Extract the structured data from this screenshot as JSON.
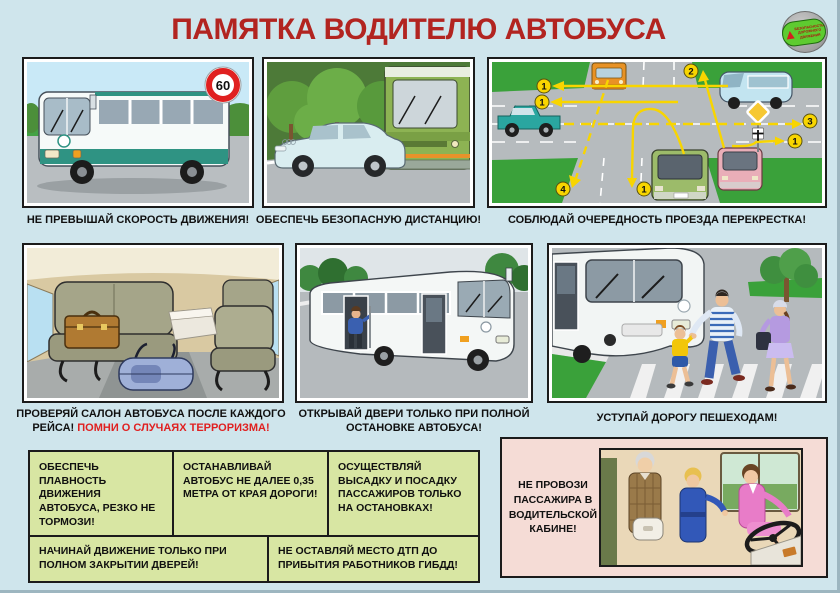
{
  "poster": {
    "title": "ПАМЯТКА ВОДИТЕЛЮ АВТОБУСА",
    "logo": {
      "line1": "БЕЗОПАСНОСТЬ",
      "line2": "ДОРОЖНОГО",
      "line3": "ДВИЖЕНИЯ"
    }
  },
  "panels": {
    "speed": {
      "caption": "НЕ ПРЕВЫШАЙ СКОРОСТЬ ДВИЖЕНИЯ!",
      "speed_sign": "60"
    },
    "distance": {
      "caption": "ОБЕСПЕЧЬ БЕЗОПАСНУЮ ДИСТАНЦИЮ!"
    },
    "intersection": {
      "caption": "СОБЛЮДАЙ ОЧЕРЕДНОСТЬ ПРОЕЗДА ПЕРЕКРЕСТКА!",
      "badges": [
        "1",
        "1",
        "2",
        "3",
        "1",
        "4",
        "1"
      ]
    },
    "salon": {
      "caption": "ПРОВЕРЯЙ САЛОН АВТОБУСА ПОСЛЕ КАЖДОГО РЕЙСА!",
      "caption_warning": "ПОМНИ О СЛУЧАЯХ ТЕРРОРИЗМА!"
    },
    "doors": {
      "caption": "ОТКРЫВАЙ ДВЕРИ ТОЛЬКО ПРИ ПОЛНОЙ ОСТАНОВКЕ АВТОБУСА!"
    },
    "pedestrians": {
      "caption": "УСТУПАЙ ДОРОГУ ПЕШЕХОДАМ!"
    }
  },
  "rules": [
    "ОБЕСПЕЧЬ ПЛАВНОСТЬ ДВИЖЕНИЯ АВТОБУСА, РЕЗКО НЕ ТОРМОЗИ!",
    "ОСТАНАВЛИВАЙ АВТОБУС НЕ ДАЛЕЕ 0,35 МЕТРА ОТ КРАЯ ДОРОГИ!",
    "ОСУЩЕСТВЛЯЙ ВЫСАДКУ И ПОСАДКУ ПАССАЖИРОВ ТОЛЬКО НА ОСТАНОВКАХ!",
    "НАЧИНАЙ ДВИЖЕНИЕ ТОЛЬКО ПРИ ПОЛНОМ ЗАКРЫТИИ ДВЕРЕЙ!",
    "НЕ ОСТАВЛЯЙ МЕСТО ДТП ДО ПРИБЫТИЯ РАБОТНИКОВ ГИБДД!"
  ],
  "cab_rule": {
    "text": "НЕ ПРОВОЗИ ПАССАЖИРА В ВОДИТЕЛЬСКОЙ КАБИНЕ!"
  },
  "colors": {
    "background": "#cfe5ec",
    "title": "#b22420",
    "warning_text": "#e02020",
    "rule_box": "#d8e6a3",
    "cab_box": "#f5dcd6",
    "panel_border": "#1b1b1b",
    "arrow_yellow": "#f8d500"
  }
}
